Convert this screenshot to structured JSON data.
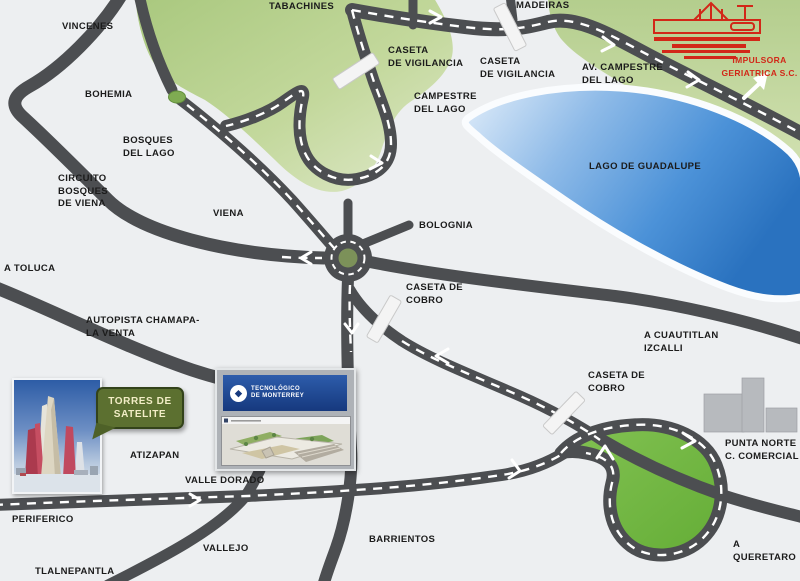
{
  "map": {
    "colors": {
      "background": "#edeff1",
      "road": "#4c4e51",
      "road_dash": "#ffffff",
      "green_area": "#b9d391",
      "loop_green": "#6fb73e",
      "lake_blue": "#2e79c8",
      "label_text": "#1b1b1b",
      "logo_red": "#d22718",
      "bubble_green": "#5c7030"
    },
    "labels": [
      {
        "id": "vincenes",
        "x": 62,
        "y": 21,
        "lines": [
          "VINCENES"
        ]
      },
      {
        "id": "tabachines",
        "x": 269,
        "y": 1,
        "lines": [
          "TABACHINES"
        ]
      },
      {
        "id": "madeiras",
        "x": 516,
        "y": 0,
        "lines": [
          "MADEIRAS"
        ]
      },
      {
        "id": "bohemia",
        "x": 85,
        "y": 89,
        "lines": [
          "BOHEMIA"
        ]
      },
      {
        "id": "bosques-del-lago",
        "x": 123,
        "y": 135,
        "lines": [
          "BOSQUES",
          "DEL LAGO"
        ]
      },
      {
        "id": "circuito-bosques-de-viena",
        "x": 58,
        "y": 173,
        "lines": [
          "CIRCUITO",
          "BOSQUES",
          "DE VIENA"
        ]
      },
      {
        "id": "viena",
        "x": 213,
        "y": 208,
        "lines": [
          "VIENA"
        ]
      },
      {
        "id": "a-toluca",
        "x": 4,
        "y": 263,
        "lines": [
          "A TOLUCA"
        ]
      },
      {
        "id": "autopista-chamapa",
        "x": 86,
        "y": 315,
        "lines": [
          "AUTOPISTA CHAMAPA-",
          "LA VENTA"
        ]
      },
      {
        "id": "caseta-vigilancia-1",
        "x": 388,
        "y": 45,
        "lines": [
          "CASETA",
          "DE VIGILANCIA"
        ]
      },
      {
        "id": "caseta-vigilancia-2",
        "x": 480,
        "y": 56,
        "lines": [
          "CASETA",
          "DE VIGILANCIA"
        ]
      },
      {
        "id": "campestre-del-lago",
        "x": 414,
        "y": 91,
        "lines": [
          "CAMPESTRE",
          "DEL LAGO"
        ]
      },
      {
        "id": "av-campestre-del-lago",
        "x": 582,
        "y": 62,
        "lines": [
          "AV. CAMPESTRE",
          "DEL LAGO"
        ]
      },
      {
        "id": "lago-de-guadalupe",
        "x": 589,
        "y": 161,
        "lines": [
          "LAGO DE GUADALUPE"
        ]
      },
      {
        "id": "impulsora-geriatrica",
        "x": 712,
        "y": 54,
        "w": 95,
        "align": "center",
        "color": "#d22718",
        "size": 8.5,
        "lines": [
          "IMPULSORA",
          "GERIATRICA S.C."
        ]
      },
      {
        "id": "bolognia",
        "x": 419,
        "y": 220,
        "lines": [
          "BOLOGNIA"
        ]
      },
      {
        "id": "caseta-cobro-centro",
        "x": 406,
        "y": 282,
        "lines": [
          "CASETA DE",
          "COBRO"
        ]
      },
      {
        "id": "a-cuautitlan-izcalli",
        "x": 644,
        "y": 330,
        "lines": [
          "A CUAUTITLAN",
          "IZCALLI"
        ]
      },
      {
        "id": "caseta-cobro-sur",
        "x": 588,
        "y": 370,
        "lines": [
          "CASETA DE",
          "COBRO"
        ]
      },
      {
        "id": "punta-norte",
        "x": 725,
        "y": 438,
        "lines": [
          "PUNTA NORTE",
          "C. COMERCIAL"
        ]
      },
      {
        "id": "atizapan",
        "x": 130,
        "y": 450,
        "lines": [
          "ATIZAPAN"
        ]
      },
      {
        "id": "valle-dorado",
        "x": 185,
        "y": 475,
        "lines": [
          "VALLE DORADO"
        ]
      },
      {
        "id": "periferico",
        "x": 12,
        "y": 514,
        "lines": [
          "PERIFERICO"
        ]
      },
      {
        "id": "vallejo",
        "x": 203,
        "y": 543,
        "lines": [
          "VALLEJO"
        ]
      },
      {
        "id": "barrientos",
        "x": 369,
        "y": 534,
        "lines": [
          "BARRIENTOS"
        ]
      },
      {
        "id": "tlalnepantla",
        "x": 35,
        "y": 566,
        "lines": [
          "TLALNEPANTLA"
        ]
      },
      {
        "id": "a-queretaro",
        "x": 733,
        "y": 539,
        "lines": [
          "A",
          "QUERETARO"
        ]
      }
    ],
    "tollbooths": [
      {
        "id": "caseta-vigilancia-1-booth",
        "x": 356,
        "y": 71,
        "angle": -33
      },
      {
        "id": "caseta-vigilancia-2-booth",
        "x": 510,
        "y": 27,
        "angle": 63
      },
      {
        "id": "caseta-cobro-centro-booth",
        "x": 384,
        "y": 319,
        "angle": -60
      },
      {
        "id": "caseta-cobro-sur-booth",
        "x": 564,
        "y": 413,
        "angle": -46
      }
    ],
    "torres_bubble": {
      "lines": [
        "TORRES DE",
        "SATELITE"
      ]
    },
    "tec_inset": {
      "banner_lines": [
        "TECNOLÓGICO",
        "DE MONTERREY"
      ]
    }
  }
}
